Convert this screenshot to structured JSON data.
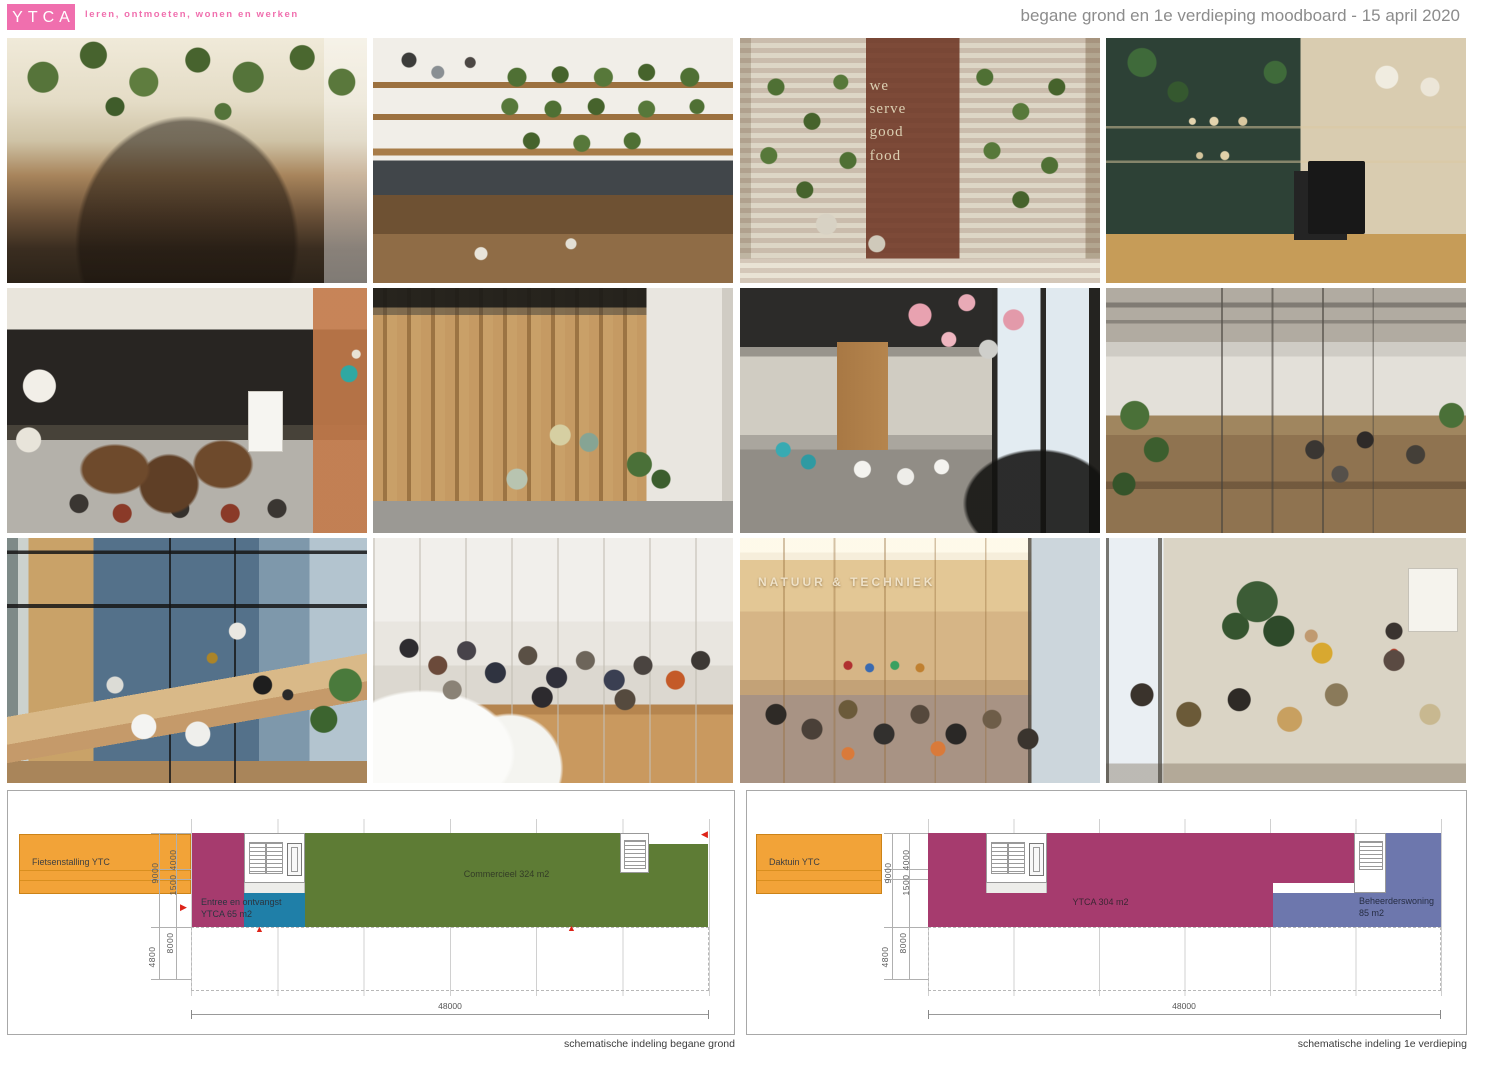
{
  "header": {
    "logo": "YTCA",
    "tagline": "leren, ontmoeten, wonen en werken",
    "title": "begane grond en 1e verdieping moodboard - 15 april 2020"
  },
  "photos": [
    {
      "name": "coworking-space-hanging-plants"
    },
    {
      "name": "cafe-plant-shelves"
    },
    {
      "name": "restaurant-brick-wall-plants",
      "overlay": "we\nserve\ngood\nfood"
    },
    {
      "name": "coffee-bar-green-wall"
    },
    {
      "name": "dark-meeting-room"
    },
    {
      "name": "wood-slat-interior"
    },
    {
      "name": "restaurant-pink-pendant-lamps"
    },
    {
      "name": "open-office-concrete-ceiling"
    },
    {
      "name": "blue-study-room-window-desk"
    },
    {
      "name": "white-stepped-study-landscape"
    },
    {
      "name": "library-natuur-techniek",
      "overlay": "NATUUR & TECHNIEK"
    },
    {
      "name": "workshop-group-discussion"
    }
  ],
  "plans": {
    "ground": {
      "caption": "schematische indeling begane grond",
      "zone_fietsenstalling": "Fietsenstalling YTC",
      "zone_entree_line1": "Entree en ontvangst",
      "zone_entree_line2": "YTCA 65 m2",
      "zone_commercieel": "Commercieel 324 m2",
      "dim_9000": "9000",
      "dim_4000": "4000",
      "dim_1500": "1500",
      "dim_8000": "8000",
      "dim_4800": "4800",
      "dim_48000": "48000"
    },
    "first": {
      "caption": "schematische indeling 1e verdieping",
      "zone_daktuin": "Daktuin YTC",
      "zone_ytca": "YTCA 304 m2",
      "zone_beheerderswoning_line1": "Beheerderswoning",
      "zone_beheerderswoning_line2": "85 m2",
      "dim_9000": "9000",
      "dim_4000": "4000",
      "dim_1500": "1500",
      "dim_8000": "8000",
      "dim_4800": "4800",
      "dim_48000": "48000"
    }
  },
  "colors": {
    "brand_pink": "#f06fae",
    "plan_orange": "#f2a338",
    "plan_magenta": "#a63b6e",
    "plan_blue": "#1f7fa8",
    "plan_green": "#5e7c35",
    "plan_slate": "#6d77ad",
    "marker_red": "#dd2318"
  },
  "markers": {
    "right_arrow": "▶",
    "up_arrow": "▲",
    "left_arrow": "◀"
  }
}
